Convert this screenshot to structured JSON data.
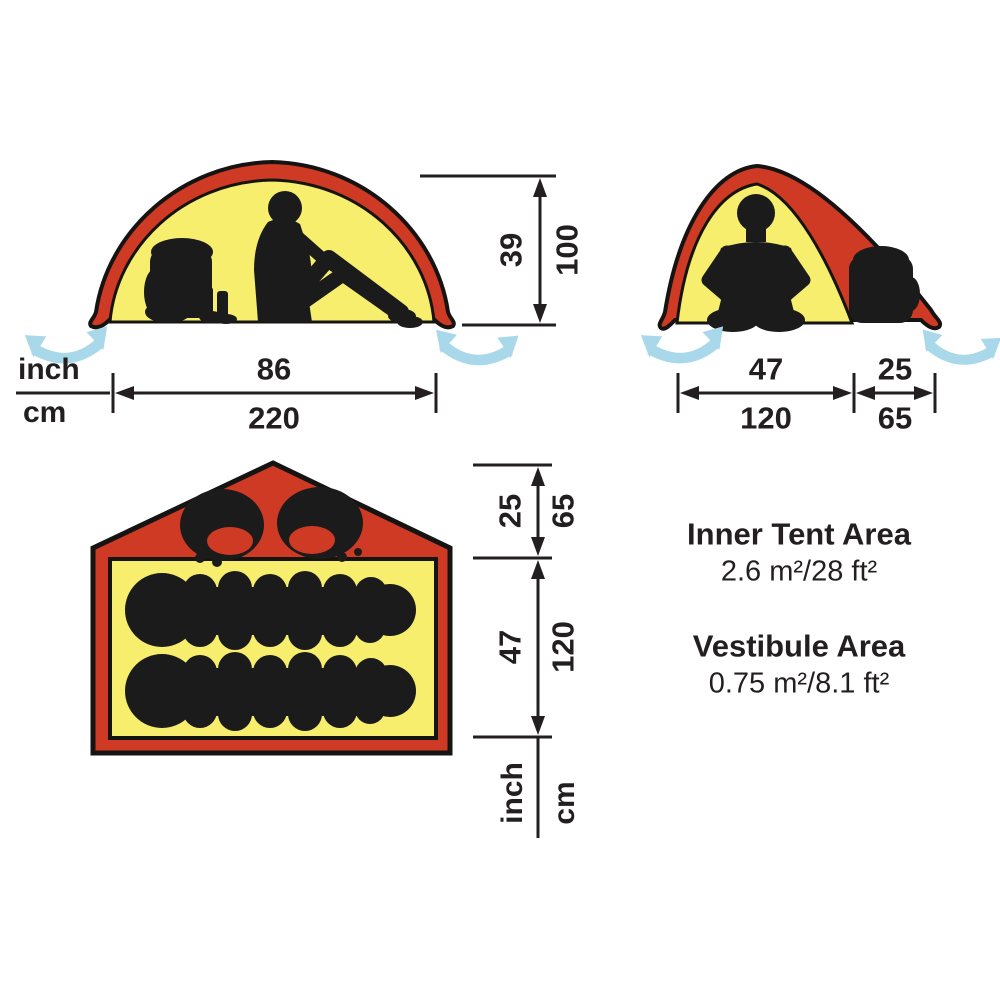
{
  "colors": {
    "tent_red": "#ce3a24",
    "tent_yellow": "#f6ee6c",
    "vent_blue": "#a8d8e9",
    "ink": "#231f20",
    "background": "#ffffff"
  },
  "side_view": {
    "name": "tent side elevation",
    "unit_inch": "inch",
    "unit_cm": "cm",
    "width": {
      "inch": "86",
      "cm": "220"
    },
    "height": {
      "inch": "39",
      "cm": "100"
    },
    "icons": [
      "backpack-silhouette",
      "boots-silhouette",
      "seated-person-silhouette",
      "ventilation-arrow",
      "ventilation-arrow"
    ]
  },
  "front_view": {
    "name": "tent front elevation",
    "inner_width": {
      "inch": "47",
      "cm": "120"
    },
    "vestibule_width": {
      "inch": "25",
      "cm": "65"
    },
    "icons": [
      "seated-person-silhouette",
      "backpack-silhouette",
      "ventilation-arrow",
      "ventilation-arrow"
    ]
  },
  "floor_plan": {
    "name": "tent floor plan",
    "unit_inch": "inch",
    "unit_cm": "cm",
    "vestibule_depth": {
      "inch": "25",
      "cm": "65"
    },
    "inner_depth": {
      "inch": "47",
      "cm": "120"
    },
    "icons": [
      "backpack-top-silhouette",
      "backpack-top-silhouette",
      "sleeping-bag-silhouette",
      "sleeping-bag-silhouette"
    ]
  },
  "areas": {
    "inner_tent": {
      "title": "Inner Tent Area",
      "value": "2.6 m²/28 ft²"
    },
    "vestibule": {
      "title": "Vestibule Area",
      "value": "0.75 m²/8.1 ft²"
    }
  }
}
